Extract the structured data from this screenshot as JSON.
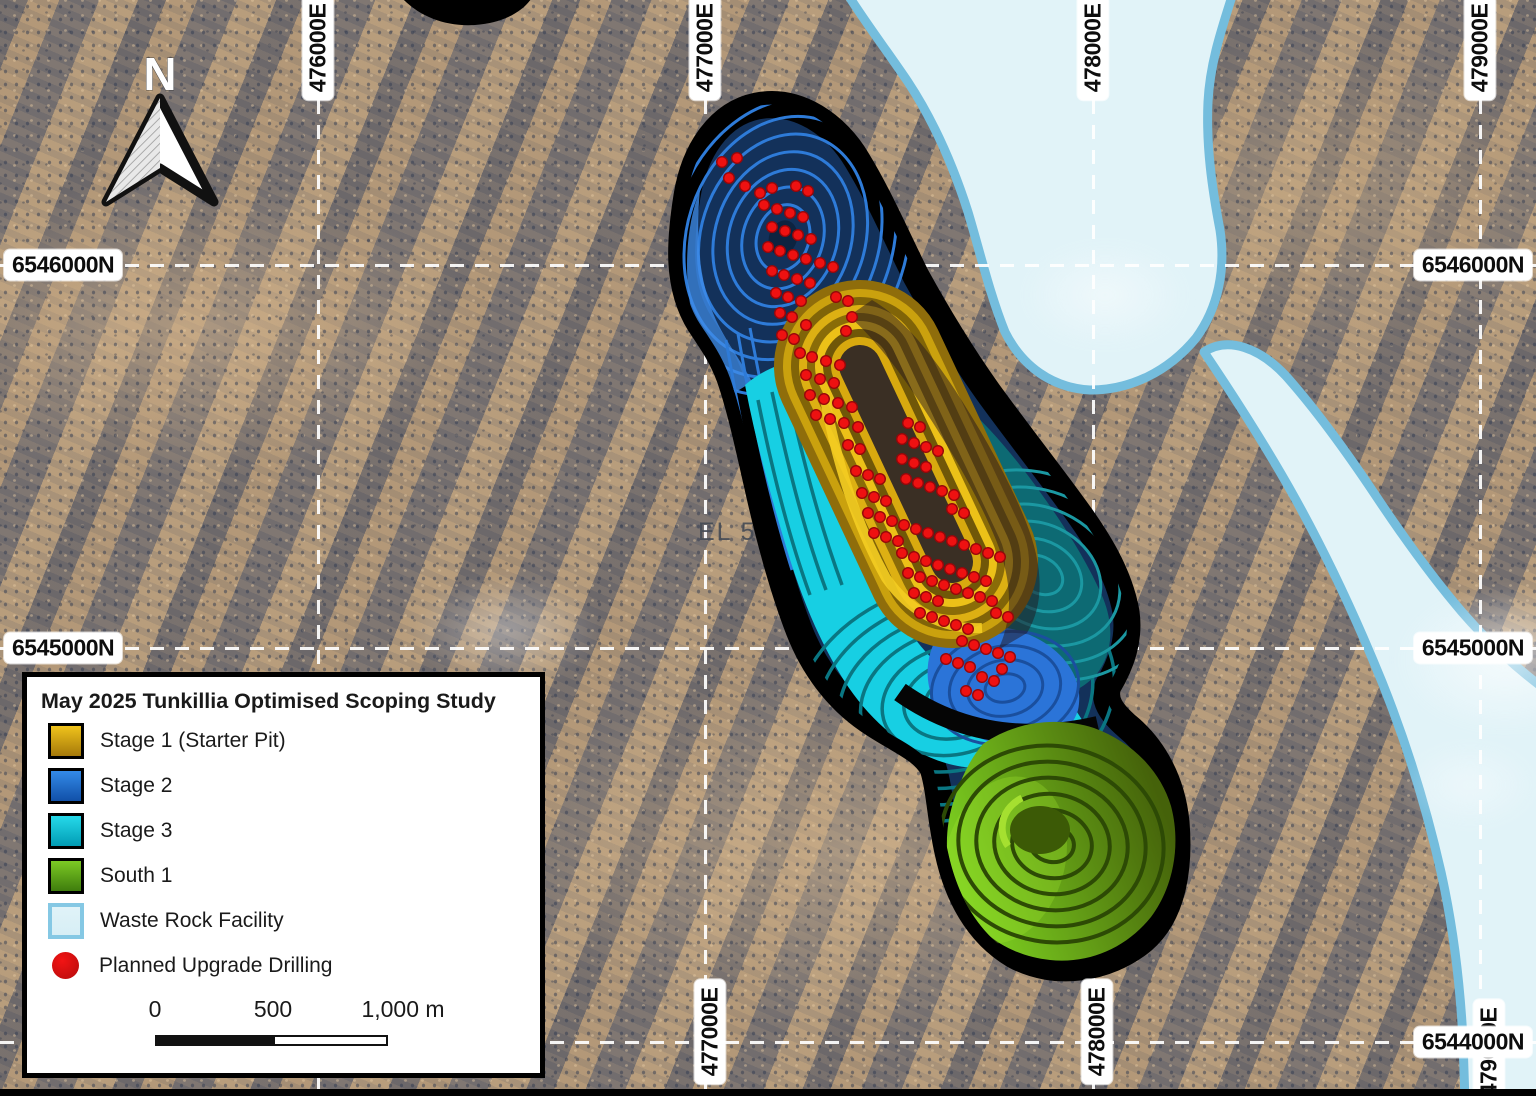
{
  "map": {
    "el_label": "EL 590",
    "north_label": "N"
  },
  "grid": {
    "top_labels": [
      {
        "text": "476000E",
        "x": 318
      },
      {
        "text": "477000E",
        "x": 705
      },
      {
        "text": "478000E",
        "x": 1093
      },
      {
        "text": "479000E",
        "x": 1480
      }
    ],
    "bottom_labels": [
      {
        "text": "477000E",
        "x": 710
      },
      {
        "text": "478000E",
        "x": 1097
      },
      {
        "text": "479000E",
        "x": 1489
      }
    ],
    "left_labels": [
      {
        "text": "6546000N",
        "y": 265
      },
      {
        "text": "6545000N",
        "y": 648
      }
    ],
    "right_labels": [
      {
        "text": "6546000N",
        "y": 265
      },
      {
        "text": "6545000N",
        "y": 648
      },
      {
        "text": "6544000N",
        "y": 1042
      }
    ],
    "vertical_x": [
      318,
      705,
      1093,
      1480
    ],
    "horizontal_y": [
      265,
      648,
      1042
    ]
  },
  "legend": {
    "title": "May 2025 Tunkillia Optimised Scoping Study",
    "items": [
      {
        "id": "stage1",
        "label": "Stage 1 (Starter Pit)",
        "swatch": "gradient",
        "top": "#f0c31c",
        "bottom": "#a5790a",
        "border": "#000000"
      },
      {
        "id": "stage2",
        "label": "Stage 2",
        "swatch": "gradient",
        "top": "#338ae8",
        "bottom": "#1150a8",
        "border": "#000000"
      },
      {
        "id": "stage3",
        "label": "Stage 3",
        "swatch": "gradient",
        "top": "#26d9ea",
        "bottom": "#019cb4",
        "border": "#000000"
      },
      {
        "id": "south1",
        "label": "South 1",
        "swatch": "gradient",
        "top": "#7cc924",
        "bottom": "#3f7d0d",
        "border": "#000000"
      },
      {
        "id": "wrf",
        "label": "Waste Rock Facility",
        "swatch": "gradient",
        "top": "#e0f3f8",
        "bottom": "#d7eef5",
        "border": "#85c8e4"
      },
      {
        "id": "drilling",
        "label": "Planned Upgrade Drilling",
        "swatch": "dot",
        "top": "#f21414",
        "bottom": "#b50b0b",
        "border": "none"
      }
    ],
    "scale": {
      "ticks": [
        {
          "text": "0",
          "x": 128
        },
        {
          "text": "500",
          "x": 246
        },
        {
          "text": "1,000 m",
          "x": 376
        }
      ],
      "bar": {
        "x": 128,
        "width": 233,
        "split": 118
      }
    }
  },
  "colors": {
    "drill_fill": "#ee1111",
    "drill_edge": "#96070a",
    "stage1_gold": "#ddb013",
    "stage2_blue": "#2e7bd8",
    "stage3_cyan": "#17cfe3",
    "south1_green": "#7ed321",
    "wrf_fill": "#e1f3f8",
    "wrf_border": "#74bddd",
    "grid_white": "#ffffff",
    "pit_outline": "#000000"
  },
  "drill_points": [
    [
      722,
      162
    ],
    [
      737,
      158
    ],
    [
      729,
      178
    ],
    [
      745,
      186
    ],
    [
      760,
      193
    ],
    [
      772,
      188
    ],
    [
      796,
      186
    ],
    [
      808,
      191
    ],
    [
      764,
      205
    ],
    [
      777,
      209
    ],
    [
      790,
      213
    ],
    [
      803,
      217
    ],
    [
      772,
      227
    ],
    [
      785,
      231
    ],
    [
      798,
      235
    ],
    [
      811,
      239
    ],
    [
      768,
      247
    ],
    [
      780,
      251
    ],
    [
      793,
      255
    ],
    [
      806,
      259
    ],
    [
      820,
      263
    ],
    [
      833,
      267
    ],
    [
      772,
      271
    ],
    [
      784,
      275
    ],
    [
      797,
      279
    ],
    [
      810,
      283
    ],
    [
      776,
      293
    ],
    [
      788,
      297
    ],
    [
      801,
      301
    ],
    [
      836,
      297
    ],
    [
      848,
      301
    ],
    [
      780,
      313
    ],
    [
      792,
      317
    ],
    [
      852,
      317
    ],
    [
      806,
      325
    ],
    [
      846,
      331
    ],
    [
      782,
      335
    ],
    [
      794,
      339
    ],
    [
      800,
      353
    ],
    [
      812,
      357
    ],
    [
      826,
      361
    ],
    [
      840,
      365
    ],
    [
      806,
      375
    ],
    [
      820,
      379
    ],
    [
      834,
      383
    ],
    [
      810,
      395
    ],
    [
      824,
      399
    ],
    [
      838,
      403
    ],
    [
      852,
      407
    ],
    [
      908,
      423
    ],
    [
      920,
      427
    ],
    [
      816,
      415
    ],
    [
      830,
      419
    ],
    [
      844,
      423
    ],
    [
      858,
      427
    ],
    [
      902,
      439
    ],
    [
      914,
      443
    ],
    [
      926,
      447
    ],
    [
      938,
      451
    ],
    [
      902,
      459
    ],
    [
      914,
      463
    ],
    [
      926,
      467
    ],
    [
      848,
      445
    ],
    [
      860,
      449
    ],
    [
      856,
      471
    ],
    [
      868,
      475
    ],
    [
      880,
      479
    ],
    [
      906,
      479
    ],
    [
      918,
      483
    ],
    [
      930,
      487
    ],
    [
      942,
      491
    ],
    [
      954,
      495
    ],
    [
      862,
      493
    ],
    [
      874,
      497
    ],
    [
      886,
      501
    ],
    [
      952,
      509
    ],
    [
      964,
      513
    ],
    [
      868,
      513
    ],
    [
      880,
      517
    ],
    [
      892,
      521
    ],
    [
      904,
      525
    ],
    [
      916,
      529
    ],
    [
      928,
      533
    ],
    [
      940,
      537
    ],
    [
      952,
      541
    ],
    [
      964,
      545
    ],
    [
      976,
      549
    ],
    [
      874,
      533
    ],
    [
      886,
      537
    ],
    [
      898,
      541
    ],
    [
      988,
      553
    ],
    [
      1000,
      557
    ],
    [
      902,
      553
    ],
    [
      914,
      557
    ],
    [
      926,
      561
    ],
    [
      938,
      565
    ],
    [
      950,
      569
    ],
    [
      962,
      573
    ],
    [
      974,
      577
    ],
    [
      986,
      581
    ],
    [
      908,
      573
    ],
    [
      920,
      577
    ],
    [
      932,
      581
    ],
    [
      944,
      585
    ],
    [
      956,
      589
    ],
    [
      968,
      593
    ],
    [
      980,
      597
    ],
    [
      992,
      601
    ],
    [
      914,
      593
    ],
    [
      926,
      597
    ],
    [
      938,
      601
    ],
    [
      996,
      613
    ],
    [
      1008,
      617
    ],
    [
      920,
      613
    ],
    [
      932,
      617
    ],
    [
      944,
      621
    ],
    [
      956,
      625
    ],
    [
      968,
      629
    ],
    [
      962,
      641
    ],
    [
      974,
      645
    ],
    [
      986,
      649
    ],
    [
      998,
      653
    ],
    [
      1010,
      657
    ],
    [
      946,
      659
    ],
    [
      958,
      663
    ],
    [
      970,
      667
    ],
    [
      1002,
      669
    ],
    [
      982,
      677
    ],
    [
      994,
      681
    ],
    [
      966,
      691
    ],
    [
      978,
      695
    ]
  ]
}
